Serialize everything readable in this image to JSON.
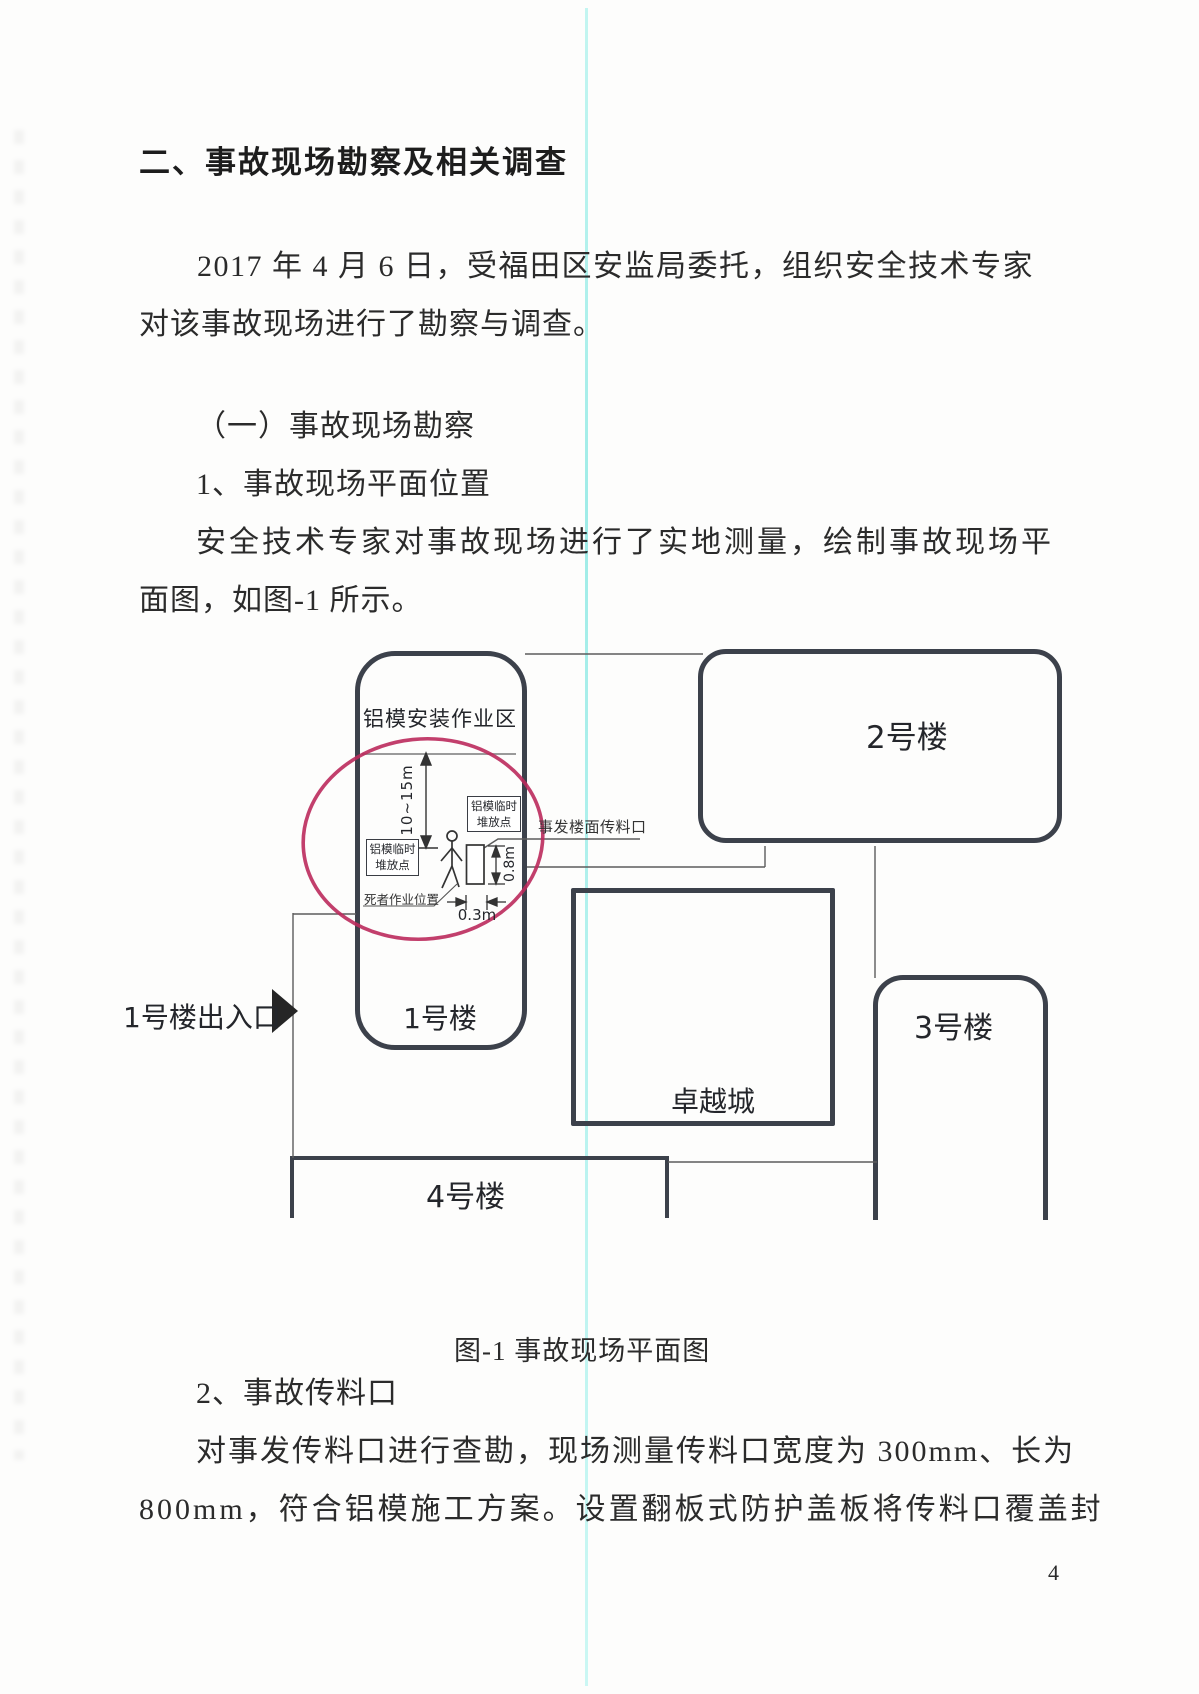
{
  "document": {
    "heading": "二、事故现场勘察及相关调查",
    "paragraph1": [
      "2017 年 4 月 6 日，受福田区安监局委托，组织安全技术专家",
      "对该事故现场进行了勘察与调查。"
    ],
    "subheading1": "（一）事故现场勘察",
    "subheading2": "1、事故现场平面位置",
    "paragraph2": [
      "安全技术专家对事故现场进行了实地测量，绘制事故现场平",
      "面图，如图-1 所示。"
    ],
    "subheading3": "2、事故传料口",
    "paragraph3": [
      "对事发传料口进行查勘，现场测量传料口宽度为 300mm、长为",
      "800mm，符合铝模施工方案。设置翻板式防护盖板将传料口覆盖封"
    ],
    "page_number": "4"
  },
  "figure": {
    "caption": "图-1 事故现场平面图",
    "buildings": {
      "zone": "铝模安装作业区",
      "b1": "1号楼",
      "b2": "2号楼",
      "b3": "3号楼",
      "b4": "4号楼",
      "mall": "卓越城"
    },
    "labels": {
      "entrance": "1号楼出入口",
      "chute_opening": "事发楼面传料口",
      "stack_point_a": "铝模临时\n堆放点",
      "stack_point_b": "铝模临时\n堆放点",
      "victim_position": "死者作业位置"
    },
    "dimensions": {
      "drop_height": "10~15m",
      "opening_length": "0.8m",
      "opening_width": "0.3m"
    }
  },
  "colors": {
    "annotation_red": "#bb2a5c",
    "scan_line_cyan": "#9ceeea",
    "building_border": "#3c414b"
  }
}
